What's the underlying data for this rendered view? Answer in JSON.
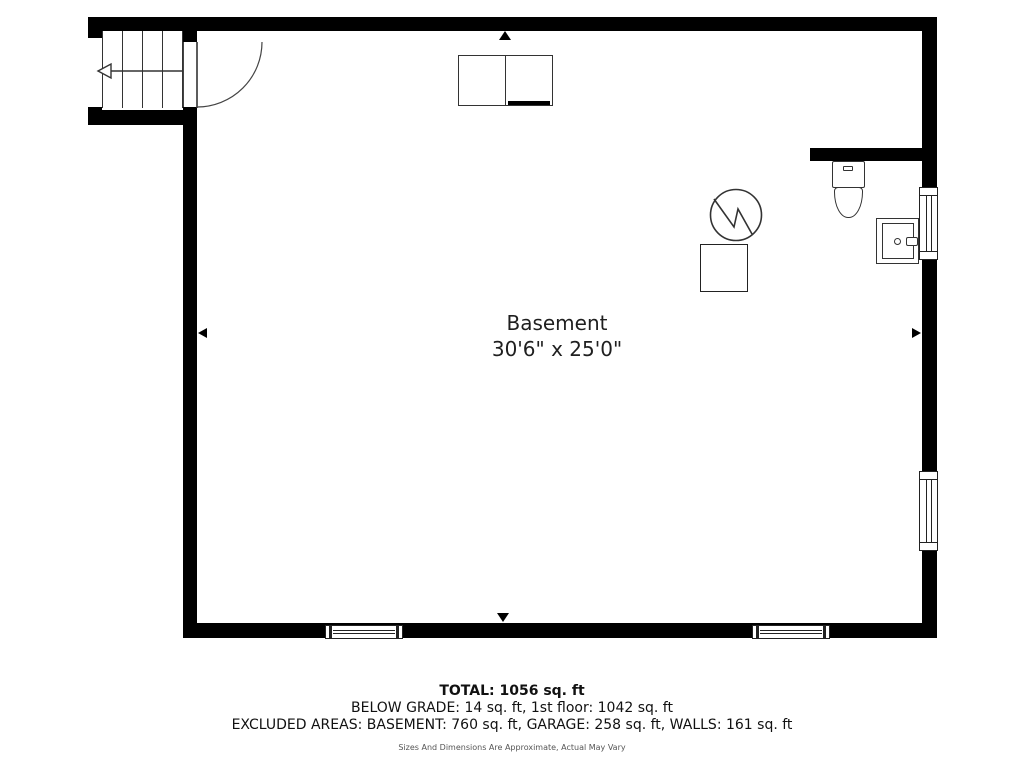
{
  "room": {
    "name": "Basement",
    "dimensions": "30'6\" x 25'0\""
  },
  "footer": {
    "total": "TOTAL: 1056 sq. ft",
    "below_grade": "BELOW GRADE: 14 sq. ft, 1st floor: 1042 sq. ft",
    "excluded_areas": "EXCLUDED AREAS: BASEMENT: 760 sq. ft, GARAGE: 258 sq. ft, WALLS: 161 sq. ft",
    "disclaimer": "Sizes And Dimensions Are Approximate, Actual May Vary"
  },
  "colors": {
    "wall": "#000000",
    "fixture_line": "#333333",
    "text": "#1a1a1a",
    "muted_text": "#555555",
    "background": "#ffffff"
  },
  "icons": [
    "stairs-icon",
    "door-swing-icon",
    "washer-dryer-icon",
    "water-heater-icon",
    "furnace-icon",
    "toilet-icon",
    "sink-icon",
    "window-icon",
    "dimension-arrow-icon"
  ]
}
